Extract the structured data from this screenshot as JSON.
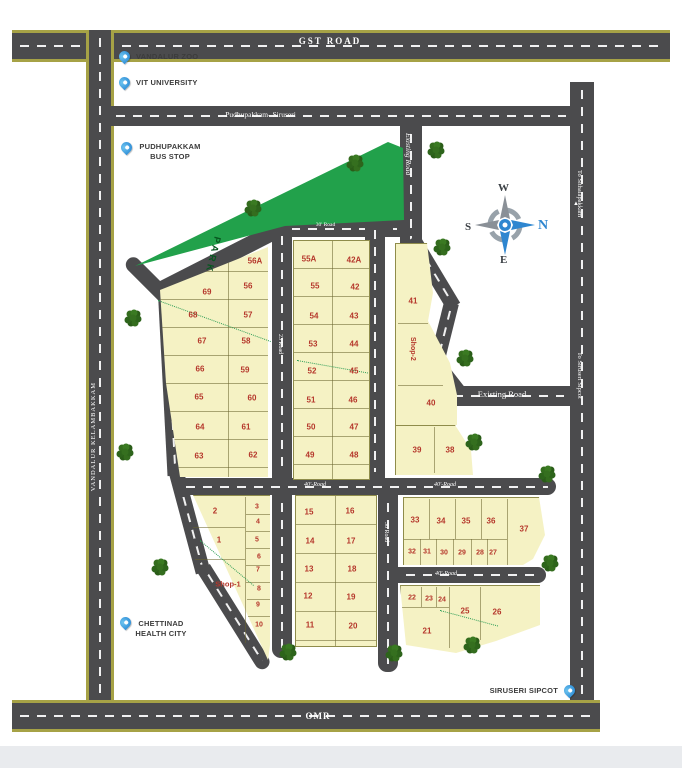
{
  "colors": {
    "road": "#4b4b4d",
    "road_edge": "#a6a246",
    "plot_fill": "#f5f2c4",
    "park_green": "#22a14b",
    "pin_blue": "#2d9ce0",
    "plot_number_red": "#b5372b"
  },
  "roads": {
    "gst": "GST ROAD",
    "pudhupakkam_siruseri": "Pudhupakkam- Siruseri",
    "vandalur_kelambakkam": "VANDALUR KELAMBAKKAM",
    "omr": "OMR",
    "existing_road_vertical": "Existing Road",
    "existing_road_horizontal": "Existing Road",
    "to_sithalapakkam": "To Sithalapakkam",
    "to_siruseri_sipcot": "To Siruseri Sipcot",
    "road_23": "23 Road",
    "road_30": "30 Road",
    "road_30_top": "30' Road",
    "road_40": "40'-Road"
  },
  "landmarks": {
    "vandalur_zoo": "VANDALUR ZOO",
    "vit_university": "VIT UNIVERSITY",
    "pudhupakkam_bus_stop": {
      "line1": "PUDHUPAKKAM",
      "line2": "BUS STOP"
    },
    "chettinad_health_city": {
      "line1": "CHETTINAD",
      "line2": "HEALTH CITY"
    },
    "siruseri_sipcot": "SIRUSERI SIPCOT"
  },
  "park_label": "PARK",
  "compass": {
    "north": "N",
    "south": "S",
    "east": "E",
    "west": "W"
  },
  "plots": {
    "ul_outer": [
      "69",
      "68",
      "67",
      "66",
      "65",
      "64",
      "63"
    ],
    "ul_inner": [
      "56A",
      "56",
      "57",
      "58",
      "59",
      "60",
      "61",
      "62"
    ],
    "um_left": [
      "55A",
      "55",
      "54",
      "53",
      "52",
      "51",
      "50",
      "49"
    ],
    "um_right": [
      "42A",
      "42",
      "43",
      "44",
      "45",
      "46",
      "47",
      "48"
    ],
    "ur": [
      "41",
      "40",
      "39",
      "38"
    ],
    "ll": [
      "2",
      "1"
    ],
    "ll_col": [
      "3",
      "4",
      "5",
      "6",
      "7",
      "8",
      "9",
      "10"
    ],
    "lm_left": [
      "15",
      "14",
      "13",
      "12",
      "11"
    ],
    "lm_right": [
      "16",
      "17",
      "18",
      "19",
      "20"
    ],
    "f_top": [
      "33",
      "34",
      "35",
      "36",
      "37"
    ],
    "f_bottom": [
      "32",
      "31",
      "30",
      "29",
      "28",
      "27"
    ],
    "g_top": [
      "22",
      "23",
      "24"
    ],
    "g_mid": [
      "25",
      "26"
    ],
    "g_21": "21",
    "shop_1": "Shop-1",
    "shop_2": "Shop-2"
  }
}
